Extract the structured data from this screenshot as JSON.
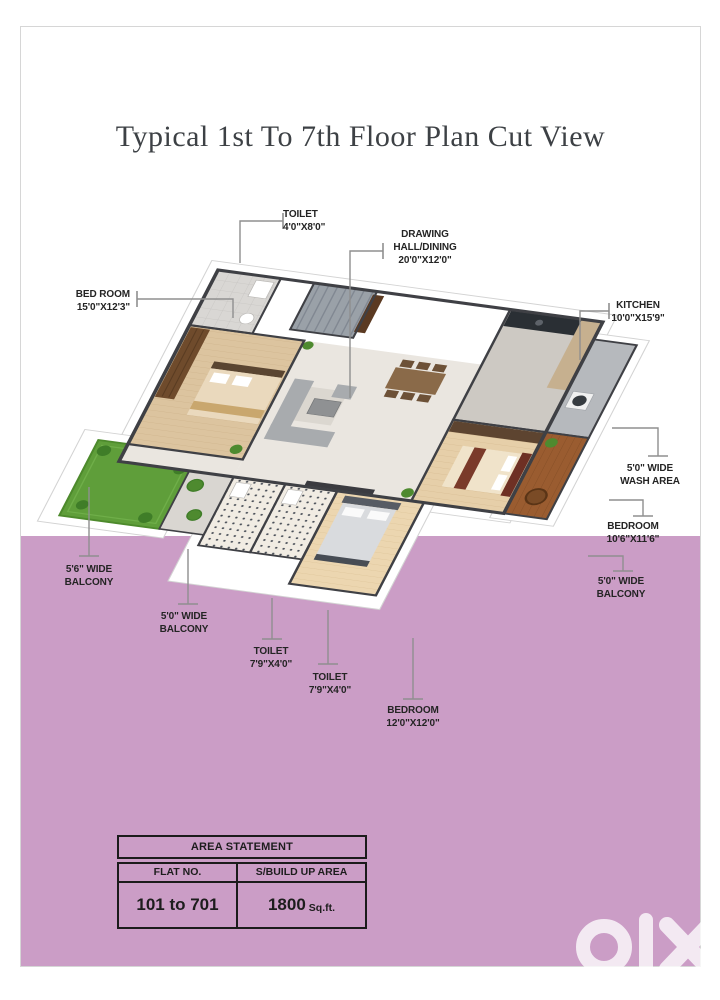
{
  "page": {
    "title": "Typical 1st To 7th Floor Plan Cut View"
  },
  "colors": {
    "pink_band": "#cb9dc6",
    "label_text": "#242424",
    "leader_line": "#8f8f8f",
    "title_text": "#3d4145"
  },
  "labels": [
    {
      "id": "toilet-top",
      "lines": [
        "TOILET",
        "4'0\"X8'0\""
      ]
    },
    {
      "id": "drawing-hall",
      "lines": [
        "DRAWING",
        "HALL/DINING",
        "20'0\"X12'0\""
      ]
    },
    {
      "id": "bedroom-left",
      "lines": [
        "BED ROOM",
        "15'0\"X12'3\""
      ]
    },
    {
      "id": "kitchen",
      "lines": [
        "KITCHEN",
        "10'0\"X15'9\""
      ]
    },
    {
      "id": "wash-area",
      "lines": [
        "5'0\" WIDE",
        "WASH AREA"
      ]
    },
    {
      "id": "bedroom-right",
      "lines": [
        "BEDROOM",
        "10'6\"X11'6\""
      ]
    },
    {
      "id": "balcony-right",
      "lines": [
        "5'0\" WIDE",
        "BALCONY"
      ]
    },
    {
      "id": "balcony-left",
      "lines": [
        "5'6\" WIDE",
        "BALCONY"
      ]
    },
    {
      "id": "balcony-left2",
      "lines": [
        "5'0\" WIDE",
        "BALCONY"
      ]
    },
    {
      "id": "toilet-b1",
      "lines": [
        "TOILET",
        "7'9\"X4'0\""
      ]
    },
    {
      "id": "toilet-b2",
      "lines": [
        "TOILET",
        "7'9\"X4'0\""
      ]
    },
    {
      "id": "bedroom-bottom",
      "lines": [
        "BEDROOM",
        "12'0\"X12'0\""
      ]
    }
  ],
  "table": {
    "title": "AREA STATEMENT",
    "col1": "FLAT NO.",
    "col2": "S/BUILD UP AREA",
    "val1": "101 to 701",
    "val2_num": "1800",
    "val2_unit": "Sq.ft."
  },
  "watermark": {
    "logo": "olx",
    "sub": "INDIA"
  }
}
